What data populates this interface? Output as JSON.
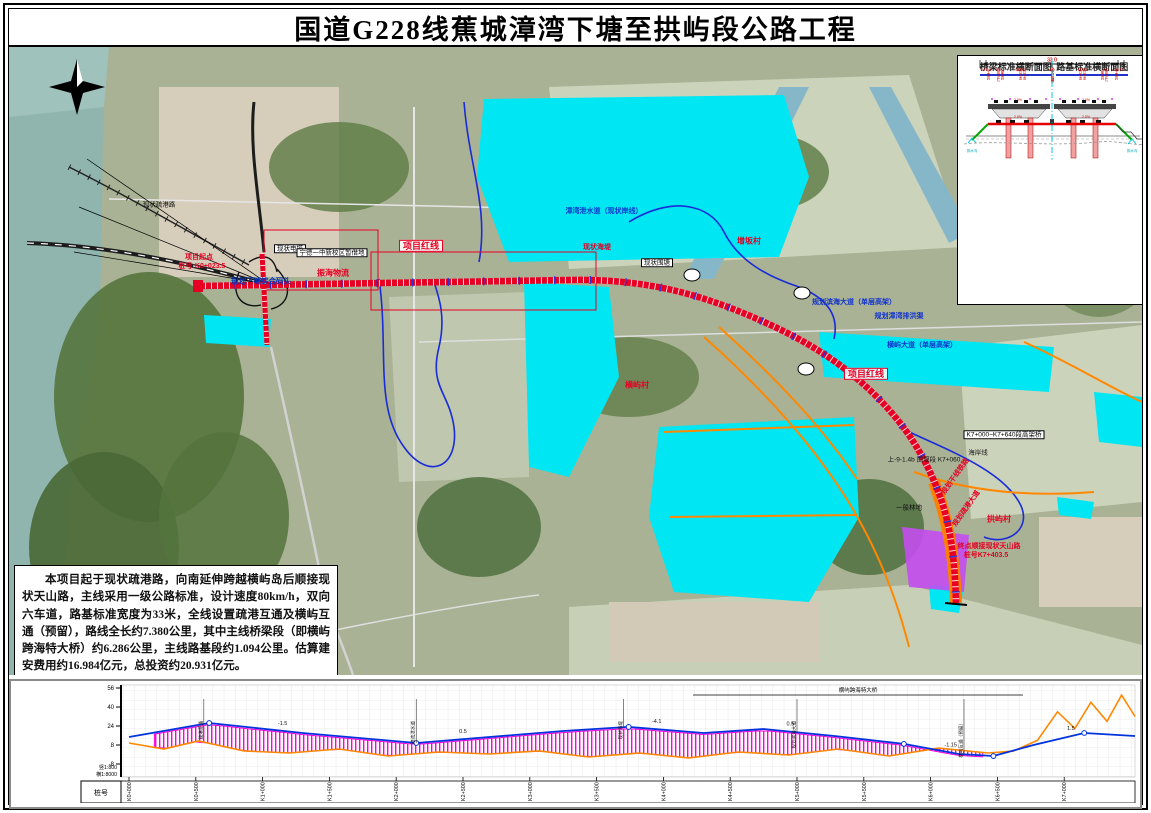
{
  "title": "国道G228线蕉城漳湾下塘至拱屿段公路工程",
  "description": "本项目起于现状疏港路，向南延伸跨越横屿岛后顺接现状天山路，主线采用一级公路标准，设计速度80km/h，双向六车道，路基标准宽度为33米，全线设置疏港互通及横屿互通（预留），路线全长约7.380公里，其中主线桥梁段（即横屿跨海特大桥）约6.286公里，主线路基段约1.094公里。估算建安费用约16.984亿元，总投资约20.931亿元。",
  "colors": {
    "route_red": "#e60023",
    "planned_cyan": "#00e6f2",
    "boundary_blue": "#1a2bd8",
    "planned_road_orange": "#ff8800",
    "bridge_hatch_magenta": "#ff00dd"
  },
  "cross_sections": {
    "bridge": {
      "title": "桥梁标准横断面图",
      "total_width": "33.0",
      "dims": [
        "0.5",
        "15.25",
        "1.0",
        "15.25",
        "0.5"
      ],
      "parts": [
        "防撞护栏",
        "行车道",
        "中央分隔带",
        "行车道",
        "防撞护栏"
      ],
      "slope_left": "2.0%",
      "slope_right": "2.0%"
    },
    "roadbed": {
      "title": "路基标准横断面图",
      "total_width": "33.0",
      "dims": [
        "0.75",
        "3.0",
        "11.25",
        "3.0",
        "11.25",
        "3.0",
        "0.75"
      ],
      "parts": [
        "土路肩",
        "硬路肩",
        "行车道",
        "中央分隔带",
        "行车道",
        "硬路肩",
        "土路肩"
      ],
      "slope_left": "2.0%",
      "slope_right": "2.0%",
      "ditch_left": "排水沟",
      "ditch_right": "排水沟"
    }
  },
  "map": {
    "labels": [
      {
        "t": "项目红线",
        "x": 412,
        "y": 199,
        "cls": "lb-redbox"
      },
      {
        "t": "项目红线",
        "x": 857,
        "y": 327,
        "cls": "lb-redbox"
      },
      {
        "t": "项目起点",
        "x": 190,
        "y": 211,
        "cls": "lb-redtext-sm"
      },
      {
        "t": "桩号:K0+023.5",
        "x": 193,
        "y": 220,
        "cls": "lb-redtext-sm"
      },
      {
        "t": "规划下塘综合码头",
        "x": 252,
        "y": 235,
        "cls": "lb-cyanlabel"
      },
      {
        "t": "现状电塔",
        "x": 281,
        "y": 202,
        "cls": "lb-blackbox"
      },
      {
        "t": "宁德一中新校区暂借地",
        "x": 323,
        "y": 206,
        "cls": "lb-blackbox"
      },
      {
        "t": "振海物流",
        "x": 324,
        "y": 226,
        "cls": "lb-redtext"
      },
      {
        "t": "现状疏港路",
        "x": 150,
        "y": 158,
        "cls": "lb-blacktext"
      },
      {
        "t": "漳湾泄水道（现状岸线）",
        "x": 595,
        "y": 165,
        "cls": "lb-bluetext"
      },
      {
        "t": "现状海堤",
        "x": 588,
        "y": 201,
        "cls": "lb-redtext-sm"
      },
      {
        "t": "现状围塘",
        "x": 648,
        "y": 216,
        "cls": "lb-blackbox"
      },
      {
        "t": "规划漳湾排洪渠",
        "x": 890,
        "y": 270,
        "cls": "lb-bluetext"
      },
      {
        "t": "规划滨海大道（单层高架）",
        "x": 845,
        "y": 256,
        "cls": "lb-bluetext"
      },
      {
        "t": "横屿大道（单层高架）",
        "x": 913,
        "y": 299,
        "cls": "lb-bluetext"
      },
      {
        "t": "横屿村",
        "x": 628,
        "y": 338,
        "cls": "lb-redtext"
      },
      {
        "t": "增坂村",
        "x": 740,
        "y": 194,
        "cls": "lb-redtext"
      },
      {
        "t": "规划干线铁路",
        "x": 947,
        "y": 430,
        "cls": "lb-redtext-sm",
        "rot": -55
      },
      {
        "t": "规划疏港大道",
        "x": 958,
        "y": 462,
        "cls": "lb-redtext-sm",
        "rot": -55
      },
      {
        "t": "一般林地",
        "x": 900,
        "y": 461,
        "cls": "lb-blacktext"
      },
      {
        "t": "海岸线",
        "x": 969,
        "y": 406,
        "cls": "lb-blacktext"
      },
      {
        "t": "K7+000~K7+640段高架桥",
        "x": 995,
        "y": 388,
        "cls": "lb-blackbox"
      },
      {
        "t": "上-9-1.4b 围堰段 K7+060",
        "x": 915,
        "y": 413,
        "cls": "lb-blacktext"
      },
      {
        "t": "拱屿村",
        "x": 990,
        "y": 472,
        "cls": "lb-redtext"
      },
      {
        "t": "终点顺接现状天山路",
        "x": 980,
        "y": 500,
        "cls": "lb-redtext-sm"
      },
      {
        "t": "桩号K7+403.5",
        "x": 977,
        "y": 509,
        "cls": "lb-redtext-sm"
      }
    ]
  },
  "profile": {
    "scale_v": "竖1:800",
    "scale_h": "横1:8000",
    "row_label": "桩号",
    "y_ticks": [
      56,
      40,
      24,
      8,
      -8
    ],
    "stations": [
      "K0+000",
      "K0+500",
      "K1+000",
      "K1+500",
      "K2+000",
      "K2+500",
      "K3+000",
      "K3+500",
      "K4+000",
      "K4+500",
      "K5+000",
      "K5+500",
      "K6+000",
      "K6+500",
      "K7+000"
    ],
    "bridge_label": "横屿跨海特大桥",
    "grades": [
      {
        "m": 1150,
        "t": "-1.5"
      },
      {
        "m": 2500,
        "t": "0.5"
      },
      {
        "m": 3950,
        "t": "-4.1"
      },
      {
        "m": 4950,
        "t": "0.5"
      },
      {
        "m": 6150,
        "t": "-1.15"
      },
      {
        "m": 7050,
        "t": "1.5"
      }
    ],
    "vlabels": [
      {
        "m": 560,
        "t": "疏港互通"
      },
      {
        "m": 2150,
        "t": "漳湾泄水道"
      },
      {
        "m": 3700,
        "t": "现状海堤"
      },
      {
        "m": 5000,
        "t": "规划滨海大道"
      },
      {
        "m": 6250,
        "t": "横屿互通（预留）"
      }
    ],
    "vc_points_m": [
      600,
      2150,
      3740,
      5800,
      6470,
      7150
    ]
  },
  "chart_data": {
    "type": "line",
    "title": "路线纵断面图",
    "xlabel": "桩号",
    "ylabel": "高程(m)",
    "ylim": [
      -19,
      56
    ],
    "x_range_m": [
      0,
      7530
    ],
    "series": [
      {
        "name": "设计线",
        "x_m": [
          0,
          600,
          1300,
          2150,
          3250,
          3740,
          4300,
          4750,
          5280,
          5800,
          6210,
          6470,
          6770,
          7150,
          7530
        ],
        "elev_m": [
          14.7,
          26.5,
          18.1,
          9.7,
          19.8,
          23.2,
          18.1,
          21.5,
          15.6,
          8.9,
          0.4,
          -1.3,
          8.0,
          18.1,
          15.6
        ]
      },
      {
        "name": "地面线",
        "x_m": [
          0,
          260,
          520,
          860,
          1200,
          1570,
          1940,
          2320,
          2700,
          3070,
          3440,
          3820,
          4190,
          4560,
          4940,
          5310,
          5690,
          6060,
          6430,
          6620,
          6800,
          6950,
          7080,
          7200,
          7320,
          7430,
          7530
        ],
        "elev_m": [
          9.7,
          4.6,
          11.4,
          3.0,
          1.3,
          4.6,
          -1.3,
          2.1,
          0.4,
          3.0,
          -2.1,
          1.3,
          -2.9,
          2.1,
          -0.4,
          4.6,
          -1.3,
          5.4,
          1.3,
          2.9,
          12.0,
          36.0,
          22.0,
          44.0,
          28.0,
          50.0,
          32.0
        ]
      }
    ],
    "bridge_section_m": [
      190,
      6390
    ],
    "legend_position": "none",
    "grid": true
  }
}
